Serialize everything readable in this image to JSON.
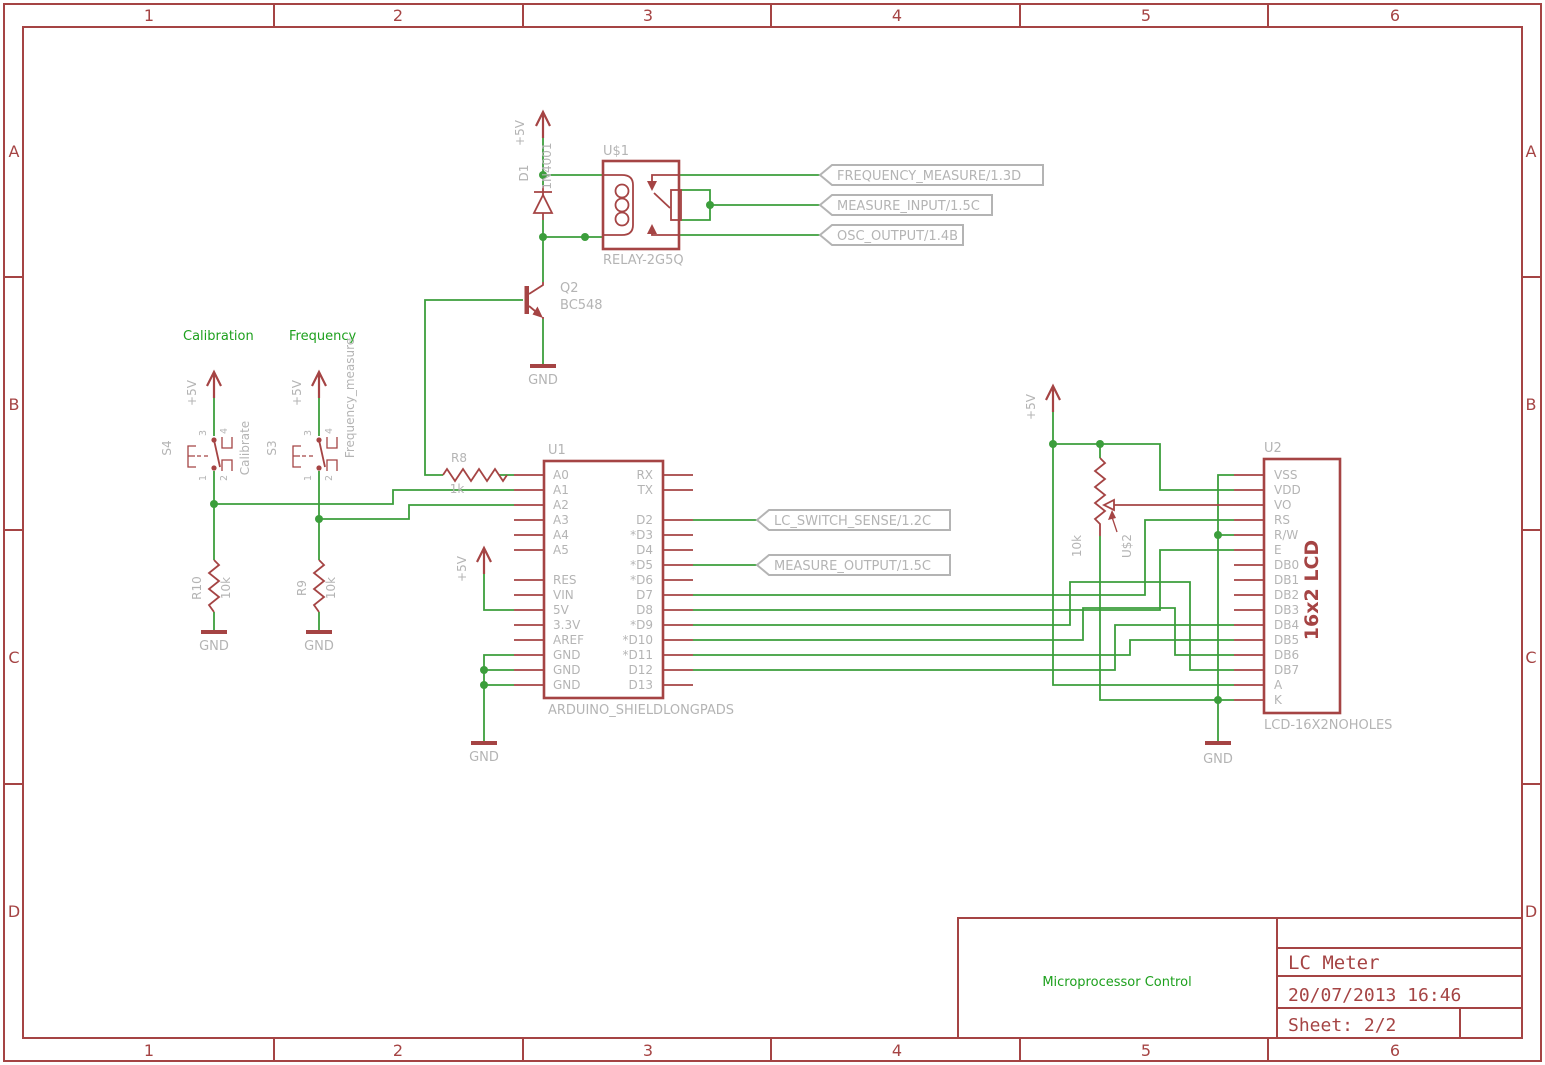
{
  "colors": {
    "component_red": "#a54444",
    "wire_green": "#3c9e3c",
    "label_gray": "#b4b4b4",
    "net_text_green": "#1da01d",
    "background": "#ffffff"
  },
  "frame": {
    "columns": [
      "1",
      "2",
      "3",
      "4",
      "5",
      "6"
    ],
    "rows": [
      "A",
      "B",
      "C",
      "D"
    ]
  },
  "title_block": {
    "note": "Microprocessor Control",
    "title": "LC Meter",
    "date": "20/07/2013 16:46",
    "sheet": "Sheet: 2/2"
  },
  "power": {
    "vcc": "+5V",
    "gnd": "GND"
  },
  "relay": {
    "ref": "U$1",
    "value": "RELAY-2G5Q"
  },
  "diode": {
    "ref": "D1",
    "value": "1N4001"
  },
  "transistor": {
    "ref": "Q2",
    "value": "BC548"
  },
  "switch_calibration": {
    "ref": "S4",
    "value": "Calibrate",
    "net_text": "Calibration",
    "pin_numbers": [
      "3",
      "4",
      "1",
      "2"
    ]
  },
  "switch_frequency": {
    "ref": "S3",
    "value": "Frequency_measure",
    "net_text": "Frequency",
    "pin_numbers": [
      "3",
      "4",
      "1",
      "2"
    ]
  },
  "resistors": {
    "r8": {
      "ref": "R8",
      "value": "1k"
    },
    "r9": {
      "ref": "R9",
      "value": "10k"
    },
    "r10": {
      "ref": "R10",
      "value": "10k"
    },
    "pot": {
      "ref": "U$2",
      "value": "10k"
    }
  },
  "net_labels": {
    "frequency_measure": "FREQUENCY_MEASURE/1.3D",
    "measure_input": "MEASURE_INPUT/1.5C",
    "osc_output": "OSC_OUTPUT/1.4B",
    "lc_switch_sense": "LC_SWITCH_SENSE/1.2C",
    "measure_output": "MEASURE_OUTPUT/1.5C"
  },
  "arduino": {
    "ref": "U1",
    "value": "ARDUINO_SHIELDLONGPADS",
    "pins_left": [
      "A0",
      "A1",
      "A2",
      "A3",
      "A4",
      "A5",
      "RES",
      "VIN",
      "5V",
      "3.3V",
      "AREF",
      "GND",
      "GND",
      "GND"
    ],
    "pins_right": [
      "RX",
      "TX",
      "D2",
      "*D3",
      "D4",
      "*D5",
      "*D6",
      "D7",
      "D8",
      "*D9",
      "*D10",
      "*D11",
      "D12",
      "D13"
    ]
  },
  "lcd": {
    "ref": "U2",
    "value": "LCD-16X2NOHOLES",
    "inner_label": "16x2 LCD",
    "pins": [
      "VSS",
      "VDD",
      "VO",
      "RS",
      "R/W",
      "E",
      "DB0",
      "DB1",
      "DB2",
      "DB3",
      "DB4",
      "DB5",
      "DB6",
      "DB7",
      "A",
      "K"
    ]
  }
}
